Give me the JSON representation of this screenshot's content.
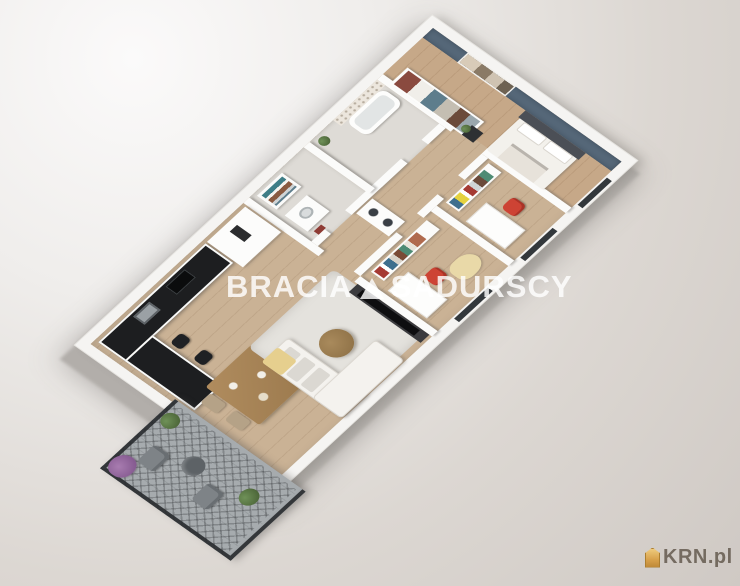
{
  "watermark": {
    "left": "BRACIA",
    "right": "SADURSCY",
    "separator_icon": "triangle-logo",
    "color": "#ffffff"
  },
  "brand_logo": {
    "text": "KRN.pl",
    "icon": "house-icon",
    "icon_color": "#d79b3c",
    "text_color": "#6b6156"
  },
  "scene": {
    "type": "3d-apartment-floorplan-render",
    "palette": {
      "background_top_left": "#fbfafa",
      "background_bottom_right": "#cfc9c4",
      "walls": "#f5f4f2",
      "wood_floor": "#cab295",
      "bathroom_floor": "#dedbd6",
      "accent_wall_blue": "#566879",
      "kitchen_counter_black": "#1d1e20",
      "desk_chair_red": "#cd4334",
      "sofa_white": "#f4f2ee",
      "rug_light": "#e4e2dd",
      "balcony_railing_dark": "#34373a",
      "plant_purple": "#9b6fa3",
      "plant_green": "#5d7d4f"
    },
    "rooms": [
      {
        "name": "open-kitchen-living-dining",
        "items": [
          "kitchen counter with sink and cooktop",
          "kitchen peninsula with two bar stools",
          "tall cabinet column with oven",
          "wooden dining table with four chairs",
          "light area rug",
          "round wooden coffee table",
          "white corner sofa with yellow throw",
          "tv media wall"
        ]
      },
      {
        "name": "hallway",
        "items": [
          "washer-dryer column"
        ]
      },
      {
        "name": "bathroom-laundry",
        "items": [
          "vanity with basin",
          "towel shelf",
          "red accessories"
        ]
      },
      {
        "name": "bathroom-main",
        "items": [
          "bathtub",
          "patterned tile wall",
          "green plant"
        ]
      },
      {
        "name": "kids-room-1",
        "items": [
          "bookshelf with colorful books",
          "white desk",
          "red chair",
          "yellow blanket"
        ]
      },
      {
        "name": "kids-room-2",
        "items": [
          "bookshelf with colorful books and yellow binder",
          "white desk",
          "red chair"
        ]
      },
      {
        "name": "master-bedroom",
        "items": [
          "double bed with white bedding",
          "dark headboard",
          "blue accent wall with artwork",
          "black nightstand with plant",
          "open wardrobe with clothes"
        ]
      },
      {
        "name": "balcony",
        "items": [
          "dark metal lattice railing",
          "two grey armchairs",
          "round side table",
          "purple flowering plant",
          "green potted plants"
        ]
      }
    ]
  }
}
